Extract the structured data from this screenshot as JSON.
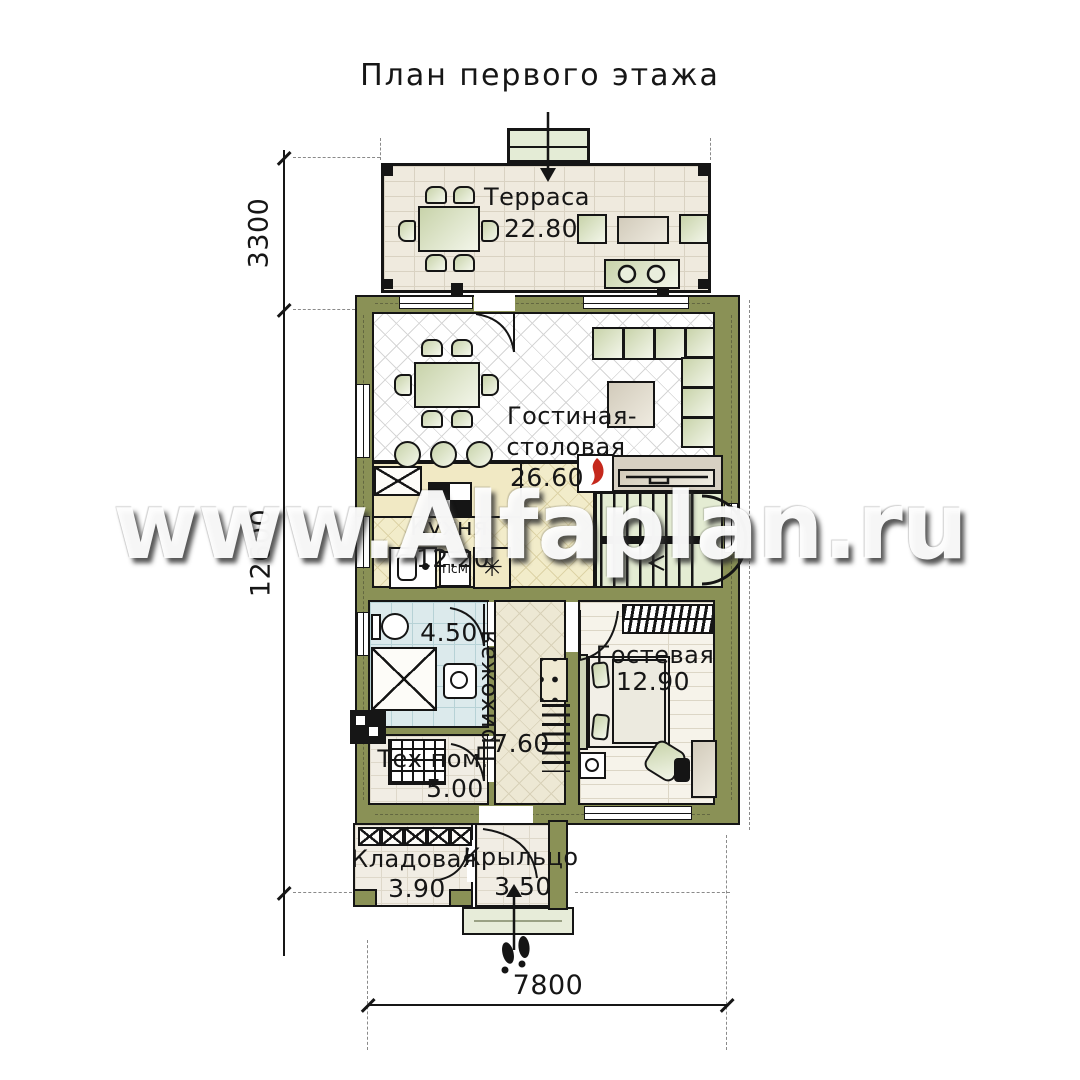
{
  "title": "План первого этажа",
  "watermark": "www.Alfaplan.ru",
  "rooms": {
    "terrace": {
      "name": "Терраса",
      "area": "22.80"
    },
    "living": {
      "name_line1": "Гостиная-",
      "name_line2": "столовая",
      "area": "26.60"
    },
    "kitchen": {
      "name": "Кухня",
      "area": "12.20"
    },
    "bathroom": {
      "area": "4.50"
    },
    "hallway": {
      "name": "Прихожая",
      "area": "7.60"
    },
    "guest": {
      "name": "Гостевая",
      "area": "12.90"
    },
    "tech": {
      "name": "Тех пом.",
      "area": "5.00"
    },
    "storage": {
      "name": "Кладовая",
      "area": "3.90"
    },
    "porch": {
      "name": "Крыльцо",
      "area": "3.50"
    }
  },
  "appliances": {
    "dishwasher_label": "ПсМ",
    "fridge_symbol": "✳"
  },
  "dimensions": {
    "terrace_depth": "3300",
    "house_length": "12600",
    "house_width": "7800"
  },
  "colors": {
    "wall_olive": "#8a9156",
    "flame_red": "#c5281c",
    "furniture_green": "#ccd6b2",
    "stair_floor": "#e4ecd3",
    "bath_tile": "#dceaec"
  }
}
